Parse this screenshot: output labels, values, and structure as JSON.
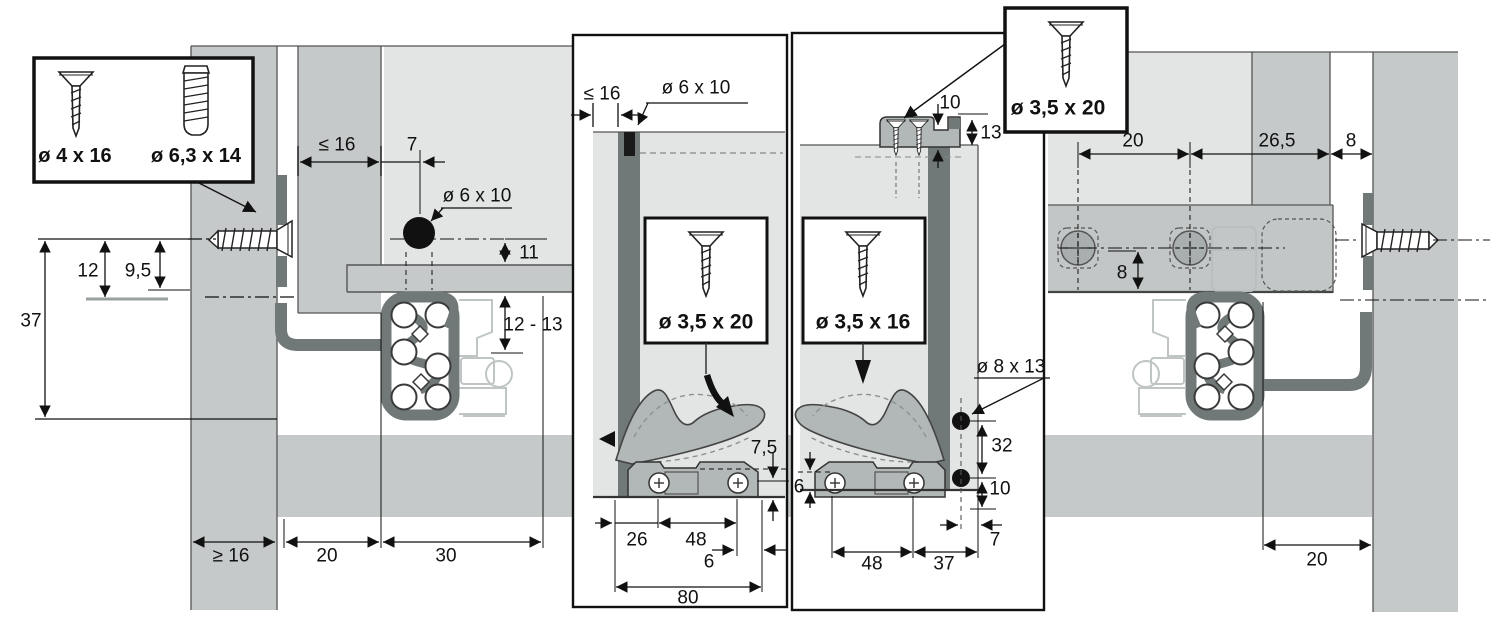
{
  "accent_colors": {
    "panel_gray": "#c6c9c9",
    "light_gray": "#e3e5e5",
    "dark_gray": "#707878",
    "bracket_gray": "#b2b8b7",
    "line_black": "#1a1a1a"
  },
  "legend_box": {
    "screw_a": "ø 4 x 16",
    "screw_b": "ø 6,3 x 14"
  },
  "cabinet_section": {
    "d12": "12",
    "d9_5": "9,5",
    "d37": "37",
    "dge16": "≥ 16",
    "d20": "20",
    "d30": "30",
    "dle16": "≤ 16",
    "d7": "7",
    "dowel": "ø 6 x 10",
    "d11": "11",
    "d12_13": "12 - 13"
  },
  "drawer_side_panel": {
    "dle16": "≤ 16",
    "dowel": "ø 6 x 10",
    "screw": "ø 3,5 x 20",
    "d7_5": "7,5",
    "d26": "26",
    "d48": "48",
    "d6": "6",
    "d80": "80"
  },
  "drawer_back_panel": {
    "screw_top": "ø 3,5 x 20",
    "d10_top": "10",
    "d13": "13",
    "screw_mid": "ø 3,5 x 16",
    "hole": "ø 8 x 13",
    "d32": "32",
    "d10": "10",
    "d6": "6",
    "d48": "48",
    "d37": "37",
    "d7": "7"
  },
  "right_section": {
    "d20_top": "20",
    "d26_5": "26,5",
    "d8_gap": "8",
    "d8_holes": "8",
    "d20_bottom": "20"
  }
}
